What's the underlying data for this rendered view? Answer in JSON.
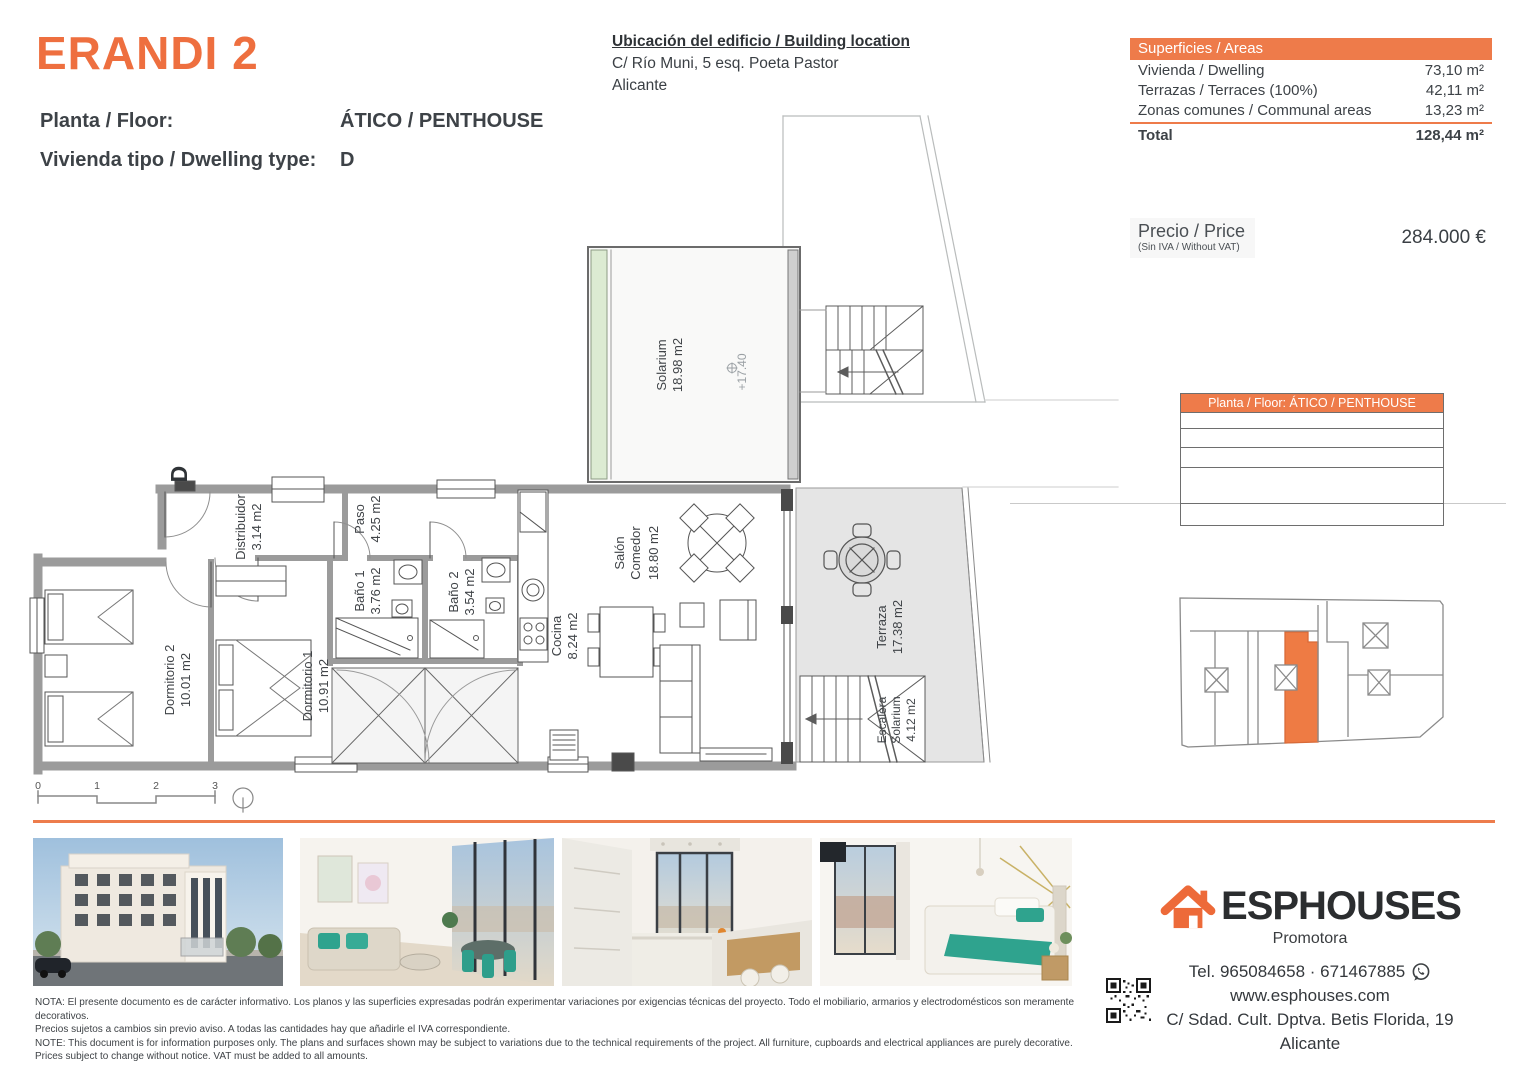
{
  "header": {
    "title": "ERANDI 2",
    "floor_label": "Planta / Floor:",
    "floor_value": "ÁTICO / PENTHOUSE",
    "type_label": "Vivienda tipo / Dwelling type:",
    "type_value": "D"
  },
  "location": {
    "title": "Ubicación del edificio / Building location",
    "address": "C/ Río Muni, 5 esq. Poeta Pastor",
    "city": "Alicante"
  },
  "areas": {
    "header": "Superficies / Areas",
    "rows": [
      {
        "label": "Vivienda / Dwelling",
        "value": "73,10 m²"
      },
      {
        "label": "Terrazas / Terraces (100%)",
        "value": "42,11 m²"
      },
      {
        "label": "Zonas comunes / Communal areas",
        "value": "13,23 m²"
      }
    ],
    "total_label": "Total",
    "total_value": "128,44 m²"
  },
  "price": {
    "label": "Precio / Price",
    "sublabel": "(Sin IVA / Without VAT)",
    "value": "284.000 €"
  },
  "floor_table": {
    "header": "Planta / Floor: ÁTICO / PENTHOUSE"
  },
  "plan": {
    "type_letter": "D",
    "level_mark": "+17.40",
    "rooms": {
      "solarium": {
        "name": "Solarium",
        "area": "18.98 m2"
      },
      "distribuidor": {
        "name": "Distribuidor",
        "area": "3.14 m2"
      },
      "paso": {
        "name": "Paso",
        "area": "4.25 m2"
      },
      "bano1": {
        "name": "Baño 1",
        "area": "3.76 m2"
      },
      "bano2": {
        "name": "Baño 2",
        "area": "3.54 m2"
      },
      "cocina": {
        "name": "Cocina",
        "area": "8.24 m2"
      },
      "salon": {
        "name": "Salón",
        "name2": "Comedor",
        "area": "18.80 m2"
      },
      "dormitorio2": {
        "name": "Dormitorio 2",
        "area": "10.01 m2"
      },
      "dormitorio1": {
        "name": "Dormitorio 1",
        "area": "10.91 m2"
      },
      "terraza": {
        "name": "Terraza",
        "area": "17.38 m2"
      },
      "escalera": {
        "name": "Escalera",
        "name2": "Solarium",
        "area": "4.12 m2"
      }
    },
    "scale_ticks": [
      "0",
      "1",
      "2",
      "3"
    ]
  },
  "notes": {
    "line1": "NOTA: El presente documento es de carácter informativo. Los planos y las superficies expresadas podrán experimentar variaciones por exigencias técnicas del proyecto. Todo el mobiliario, armarios y electrodomésticos son meramente decorativos.",
    "line2": "Precios sujetos a cambios sin previo aviso. A todas las cantidades hay que añadirle el IVA correspondiente.",
    "line3": "NOTE: This document is for information purposes only. The plans and surfaces shown may be subject to variations due to the technical requirements of the project. All furniture, cupboards and electrical appliances are purely decorative.",
    "line4": "Prices subject to change without notice. VAT must be added to all amounts."
  },
  "footer": {
    "brand": "ESPHOUSES",
    "subtitle": "Promotora",
    "phone": "Tel. 965084658 · 671467885",
    "website": "www.esphouses.com",
    "address": "C/ Sdad. Cult. Dptva. Betis Florida, 19",
    "city": "Alicante"
  },
  "colors": {
    "accent": "#EE6F3F",
    "accent_bar": "#EE7B4A"
  }
}
